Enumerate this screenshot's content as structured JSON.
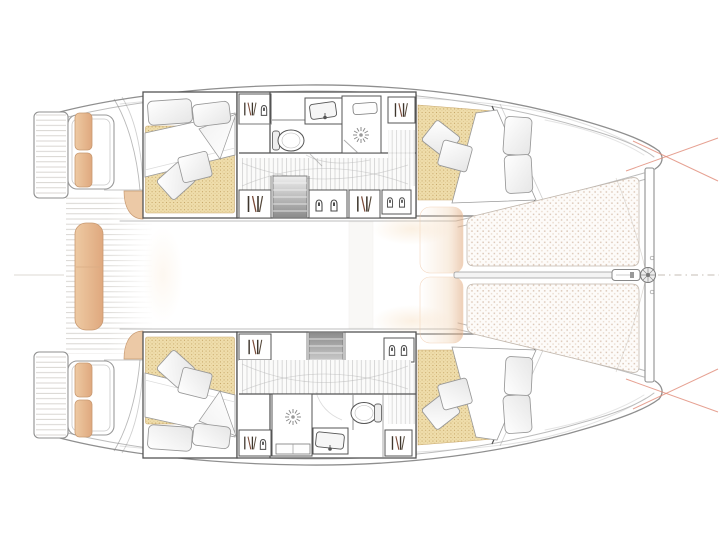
{
  "meta": {
    "kind": "catamaran-accommodation-floor-plan",
    "view": "overhead",
    "bow_direction": "right",
    "hull_count": 2,
    "cabin_count": 4,
    "bathroom_count": 2
  },
  "colors": {
    "background": "#ffffff",
    "hull_line": "#8f8f8f",
    "hull_line_light": "#bcbcbc",
    "wall_line": "#545454",
    "furniture_line": "#8a8a8a",
    "plank_line": "#d4d1cd",
    "floor_line": "#d0d0d0",
    "mattress_base": "#efddab",
    "mattress_dot": "#c2a161",
    "wood_fill": "#eecaa3",
    "wood_deep": "#dfa87e",
    "wood_edge": "#c89a72",
    "cushion_fill": "#ecc9a6",
    "tramp_base": "#fdfbf9",
    "tramp_dot": "#dcc8b8",
    "stairs_light": "#efefef",
    "stairs_dark": "#8a8a8a",
    "annotation_line": "#e08a77",
    "glow": "#f6dcbb",
    "centerline": "#c6beb4"
  },
  "regions": {
    "port_hull": [
      "aft-cabin",
      "bathroom",
      "companionway-stairs",
      "forward-cabin",
      "forepeak"
    ],
    "starboard_hull": [
      "aft-cabin",
      "bathroom",
      "companionway-stairs",
      "forward-cabin",
      "forepeak"
    ],
    "shared": [
      "aft-cockpit",
      "swim-platforms",
      "cockpit-table",
      "foredeck-pads",
      "trampoline",
      "forward-crossbeam",
      "bowsprit-furler"
    ]
  },
  "icons": [
    "hanging-locker-icon",
    "storage-jar-icon",
    "shower-drain-icon",
    "toilet-icon",
    "sink-icon",
    "stairs-icon"
  ]
}
